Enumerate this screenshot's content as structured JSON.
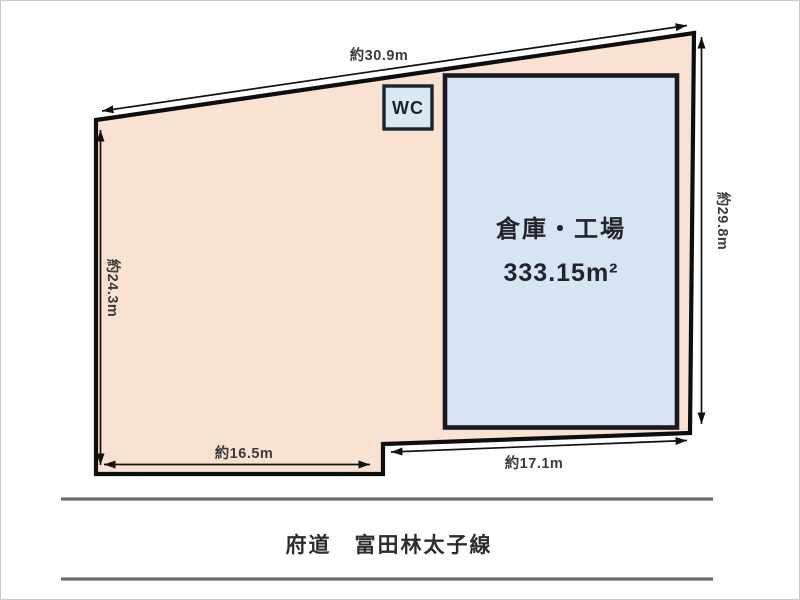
{
  "colors": {
    "parcel_fill": "#f9e2d2",
    "parcel_border": "#0e0e0e",
    "building_fill": "#d7e4f1",
    "building_border": "#191923",
    "wc_fill": "#d9e8f3",
    "road_line": "#6e6e6e"
  },
  "parcel": {
    "dim_top": "約30.9m",
    "dim_left": "約24.3m",
    "dim_right": "約29.8m",
    "dim_bottom_left": "約16.5m",
    "dim_bottom_right": "約17.1m"
  },
  "building": {
    "name": "倉庫・工場",
    "area": "333.15m²"
  },
  "wc": {
    "label": "WC"
  },
  "road": {
    "name": "府道　富田林太子線"
  }
}
